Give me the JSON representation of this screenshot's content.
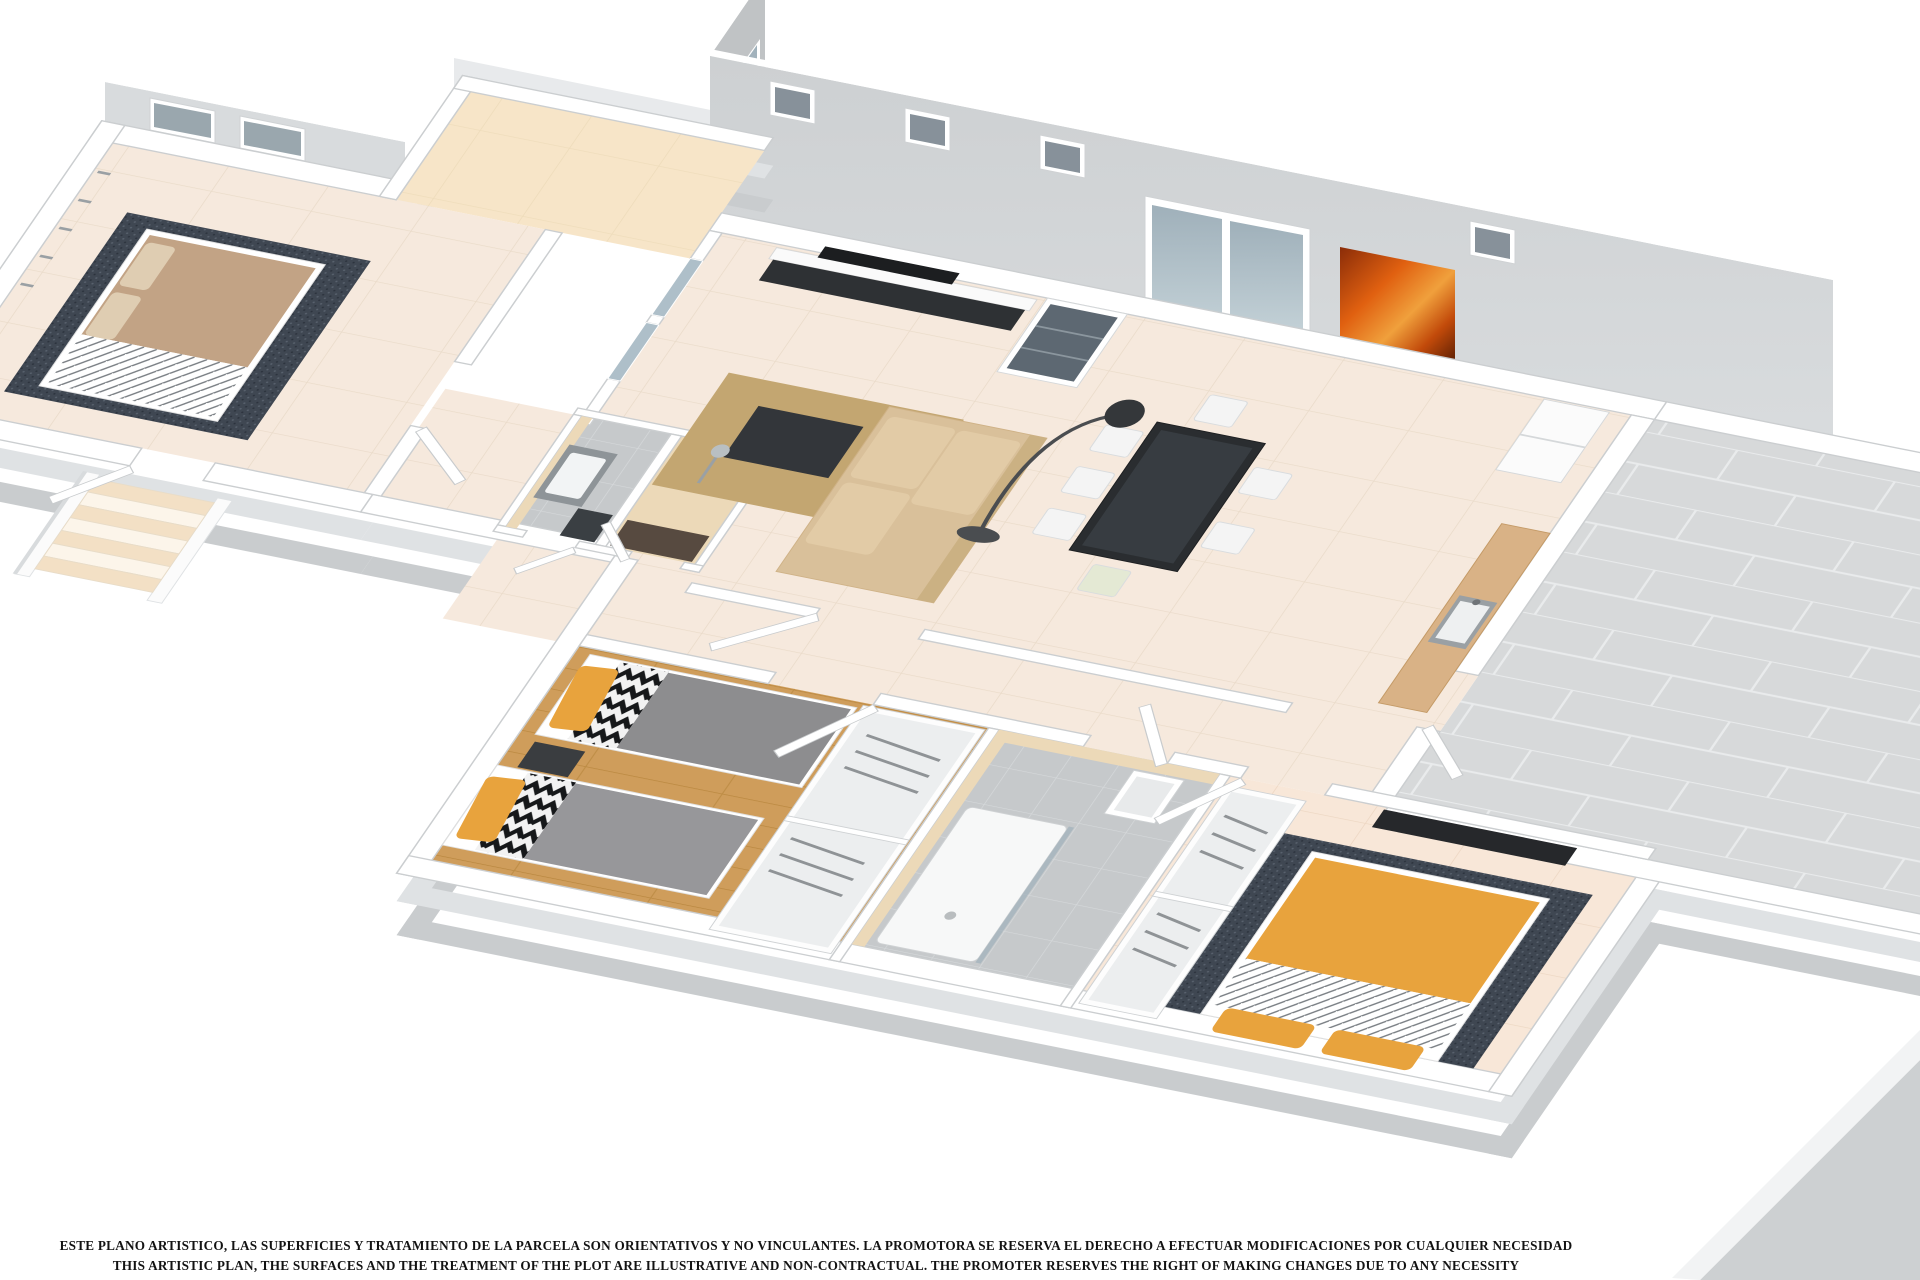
{
  "document": {
    "type": "3D artistic floor plan render",
    "background_color": "#ffffff"
  },
  "disclaimer": {
    "line_es": "ESTE PLANO ARTISTICO, LAS SUPERFICIES Y TRATAMIENTO DE LA PARCELA SON ORIENTATIVOS Y NO VINCULANTES. LA PROMOTORA SE RESERVA EL DERECHO A EFECTUAR MODIFICACIONES POR CUALQUIER NECESIDAD",
    "line_en": "THIS ARTISTIC PLAN, THE SURFACES AND THE TREATMENT OF THE PLOT ARE ILLUSTRATIVE AND NON-CONTRACTUAL. THE PROMOTER RESERVES THE RIGHT OF MAKING CHANGES DUE TO ANY NECESSITY"
  },
  "palette": {
    "wall_white": "#ffffff",
    "wall_face_gray": "#c9ccce",
    "tall_back_wall": "#d2d5d7",
    "floor_cream": "#f6e9dd",
    "floor_wood": "#cf9d5b",
    "floor_master": "#f8e7d8",
    "terrace_peach": "#f7e5c8",
    "terrace_gray": "#d7d9da",
    "bath_gray": "#c6c9cb",
    "accent_orange": "#e8a33d",
    "rug_dark": "#3f4752",
    "sofa_beige": "#d9c09a",
    "table_dark": "#2a2d30",
    "painting_orange": "#e06010"
  },
  "scene": {
    "rooms": [
      {
        "id": "bedroom-1",
        "position": "upper-left wing",
        "items": [
          "double-bed-tan",
          "dark-rug",
          "coat-hooks",
          "two-back-windows"
        ]
      },
      {
        "id": "back-terrace",
        "position": "upper-left",
        "floor": "peach-tiles"
      },
      {
        "id": "living-room",
        "items": [
          "wall-tv",
          "tv-lowboard",
          "glass-display-cabinet",
          "dark-coffee-table",
          "beige-corner-sofa",
          "tan-rug",
          "sliding-glass-doors"
        ]
      },
      {
        "id": "dining-area",
        "items": [
          "dark-glass-table",
          "white-chairs",
          "arc-floor-lamp",
          "orange-abstract-painting",
          "back-window"
        ]
      },
      {
        "id": "kitchen",
        "items": [
          "fridge",
          "wood-counter",
          "sink",
          "terrace-door"
        ]
      },
      {
        "id": "right-terrace",
        "floor": "large-gray-tiles"
      },
      {
        "id": "hallway",
        "items": [
          "interior-doors"
        ]
      },
      {
        "id": "bathroom-small",
        "items": [
          "vanity-sink",
          "dark-shower-glass"
        ]
      },
      {
        "id": "shower-room",
        "items": [
          "shower-fixture",
          "beige-tiling"
        ]
      },
      {
        "id": "bedroom-2-twin",
        "items": [
          "two-single-beds",
          "yellow-pillows",
          "chevron-blankets",
          "gray-duvets",
          "dark-nightstand",
          "wardrobe-with-hangers"
        ]
      },
      {
        "id": "bathroom-2",
        "items": [
          "shower-tray",
          "sink",
          "wardrobe-with-hangers"
        ]
      },
      {
        "id": "bedroom-3-master",
        "items": [
          "orange-double-bed",
          "white-stripe-band",
          "dark-rug",
          "wall-tv-panel",
          "wardrobe-with-hangers"
        ]
      },
      {
        "id": "entrance-stairs",
        "position": "lower-left exterior"
      }
    ]
  }
}
